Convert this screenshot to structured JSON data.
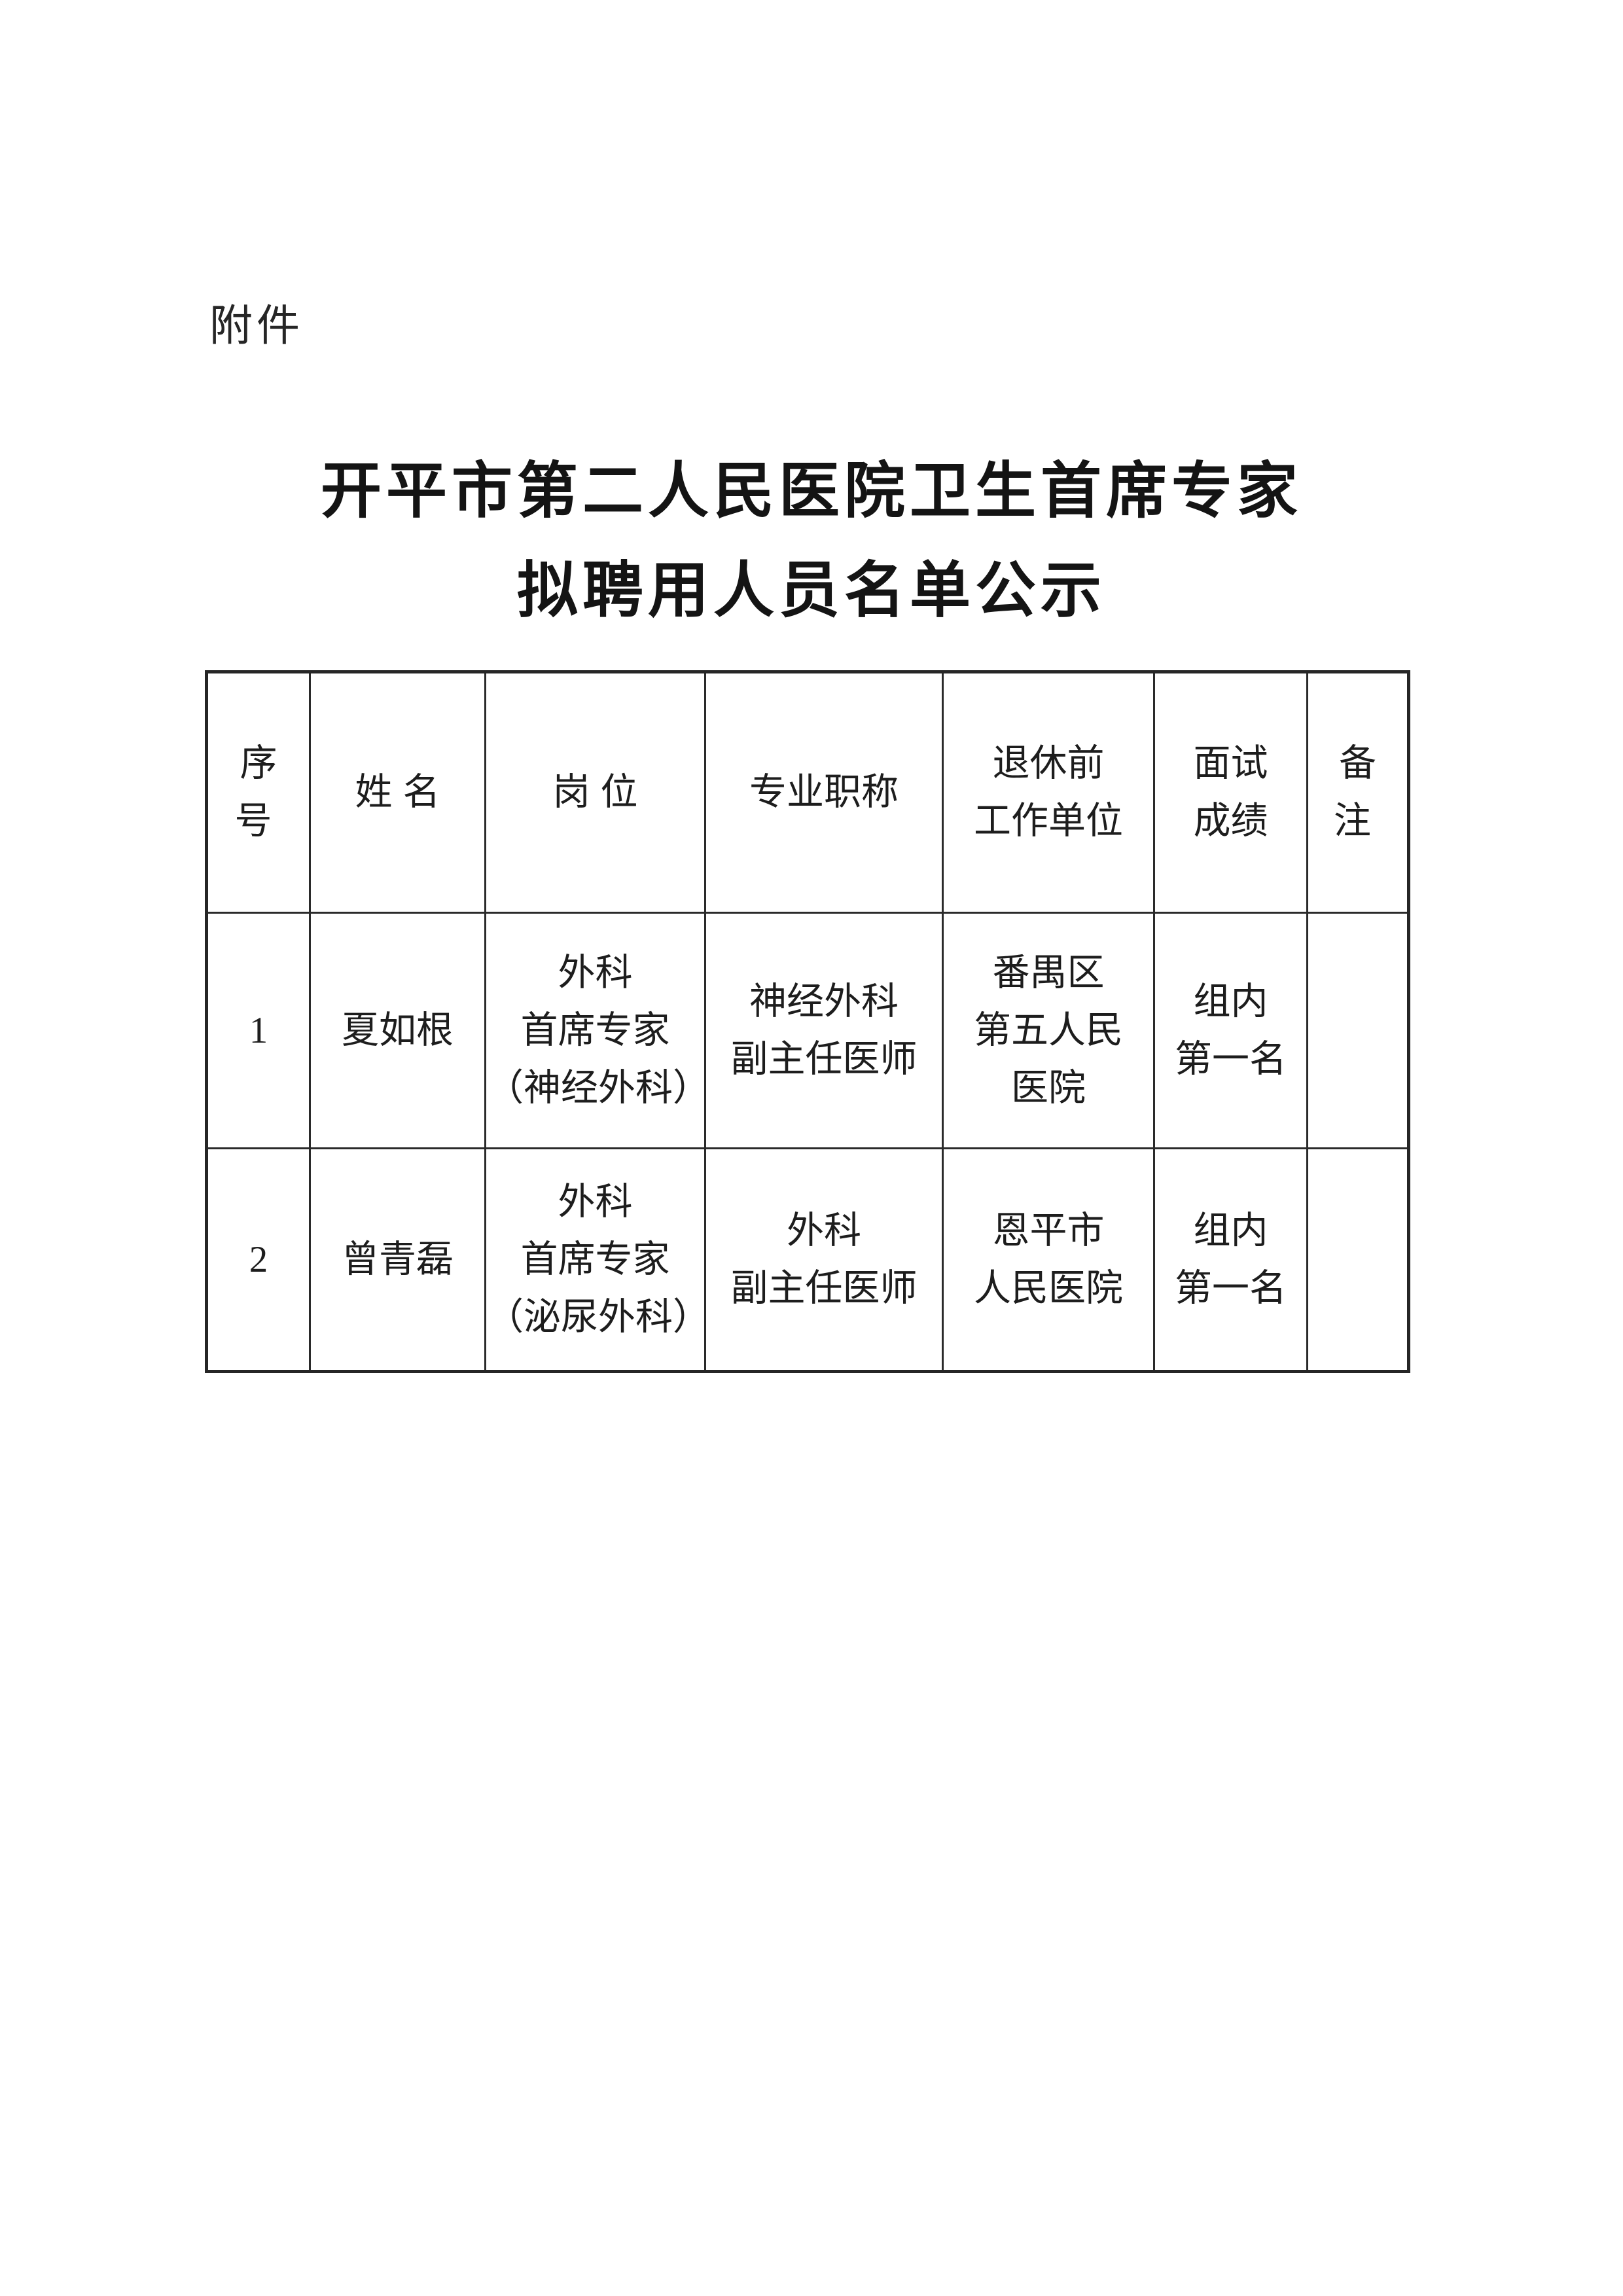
{
  "page": {
    "attachment_label": "附件",
    "title_line1": "开平市第二人民医院卫生首席专家",
    "title_line2": "拟聘用人员名单公示"
  },
  "table": {
    "headers": {
      "no": "序号",
      "name": "姓名",
      "position": "岗位",
      "professional_title": "专业职称",
      "prev_employer": "退休前\n工作单位",
      "interview_score": "面试\n成绩",
      "remarks": "备注"
    },
    "rows": [
      {
        "no": "1",
        "name": "夏如根",
        "position": "外科\n首席专家\n（神经外科）",
        "professional_title": "神经外科\n副主任医师",
        "prev_employer": "番禺区\n第五人民\n医院",
        "interview_score": "组内\n第一名",
        "remarks": ""
      },
      {
        "no": "2",
        "name": "曾青磊",
        "position": "外科\n首席专家\n（泌尿外科）",
        "professional_title": "外科\n副主任医师",
        "prev_employer": "恩平市\n人民医院",
        "interview_score": "组内\n第一名",
        "remarks": ""
      }
    ]
  },
  "colors": {
    "background": "#ffffff",
    "text": "#1d1d1d",
    "title_text": "#141414",
    "table_border": "#2a2a2a"
  }
}
